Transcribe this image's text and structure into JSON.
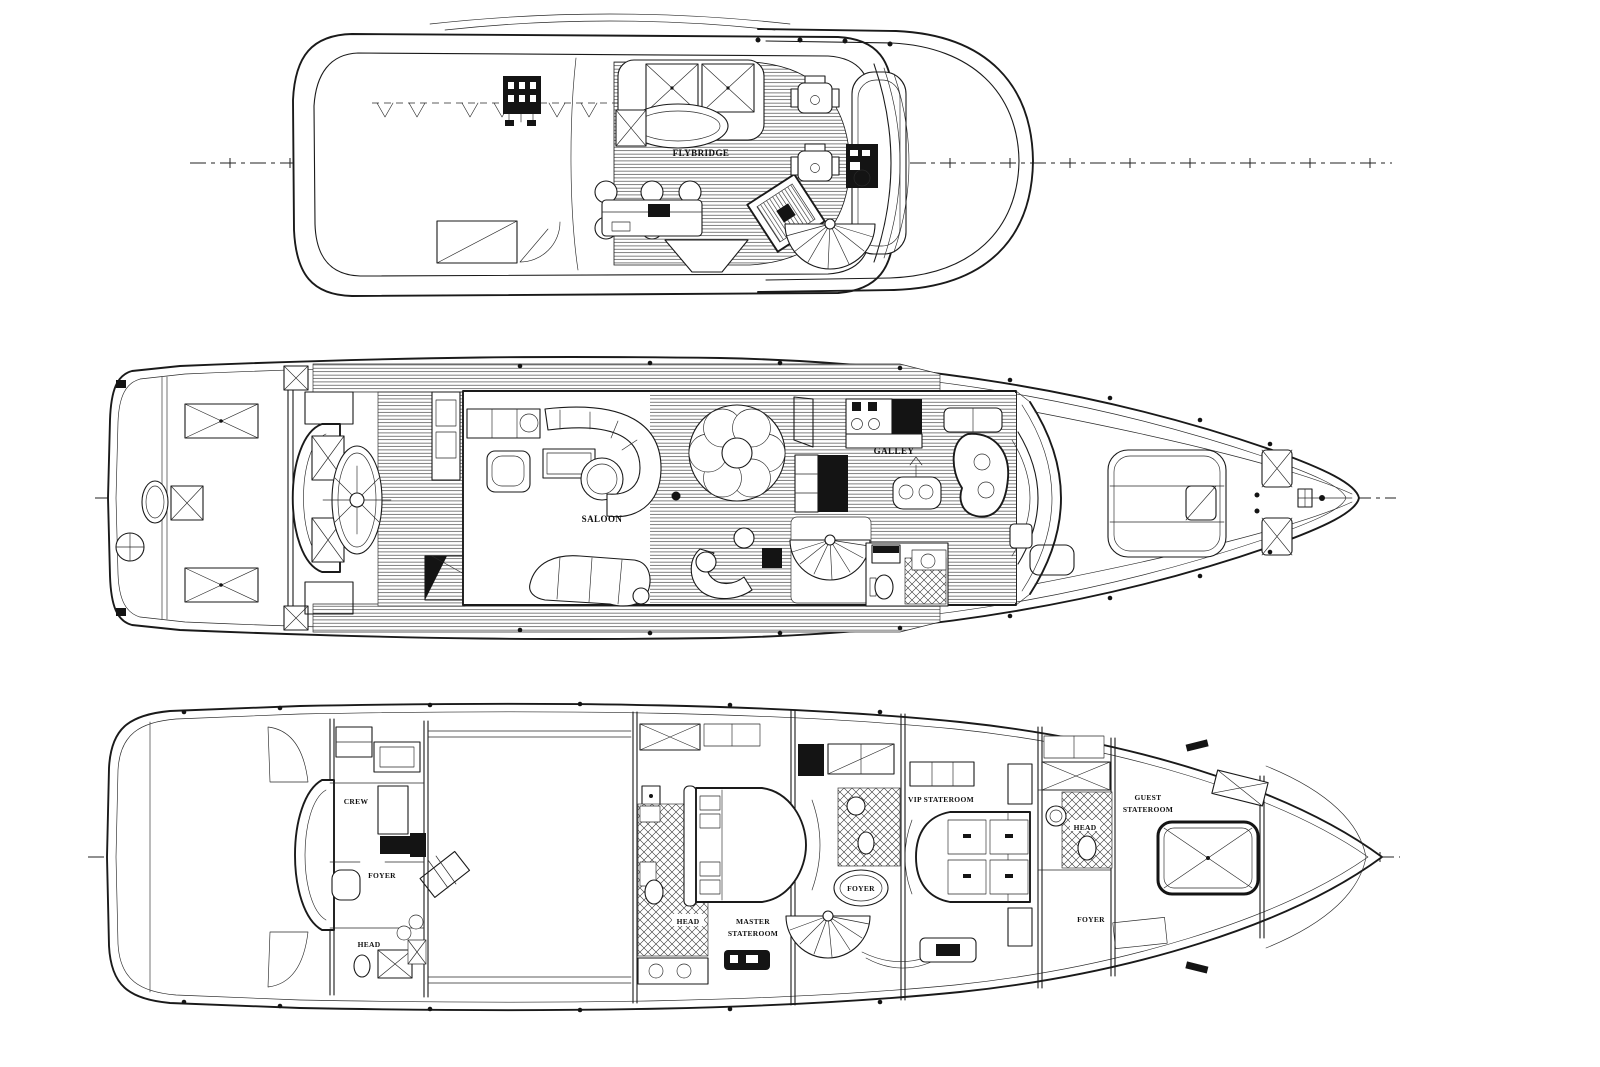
{
  "drawing": {
    "type": "yacht-deck-plans",
    "colors": {
      "background": "#ffffff",
      "ink": "#1a1a1a"
    },
    "decks": {
      "flybridge": {
        "label": "FLYBRIDGE"
      },
      "main": {
        "saloon": "SALOON",
        "galley": "GALLEY"
      },
      "lower": {
        "crew": "CREW",
        "crew_foyer": "FOYER",
        "crew_head": "HEAD",
        "master_head": "HEAD",
        "master_line1": "MASTER",
        "master_line2": "STATEROOM",
        "center_foyer": "FOYER",
        "vip": "VIP STATEROOM",
        "vip_head": "HEAD",
        "guest_line1": "GUEST",
        "guest_line2": "STATEROOM",
        "guest_foyer": "FOYER"
      }
    }
  }
}
